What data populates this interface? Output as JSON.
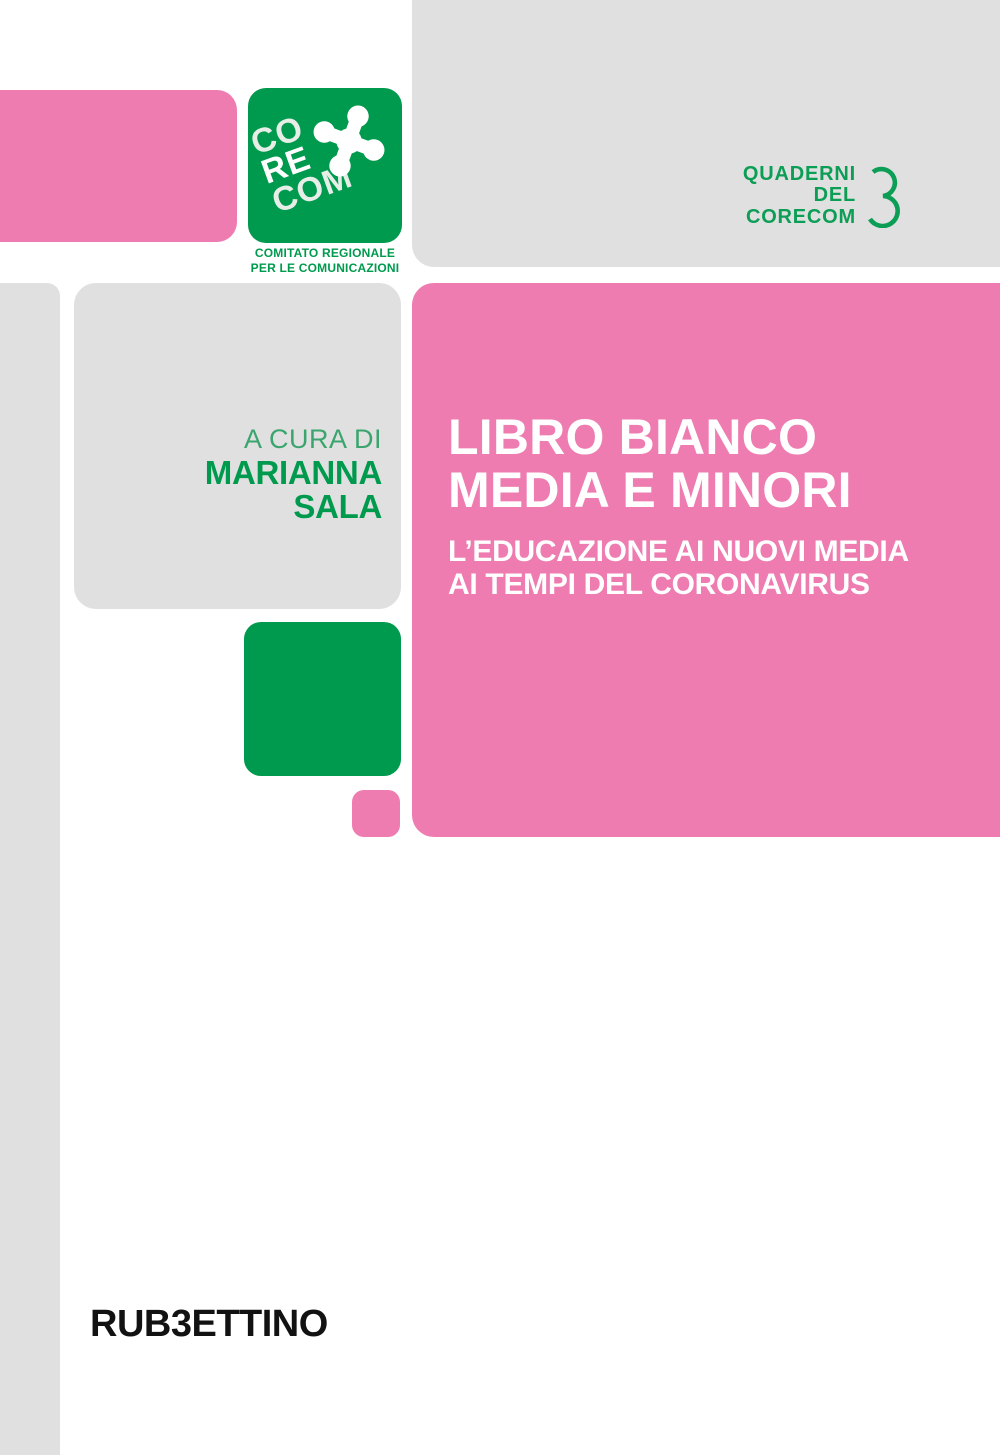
{
  "colors": {
    "pink": "#ee7cb0",
    "green": "#009a4e",
    "light_gray": "#e0e0e1",
    "logo_text_tint": "#e6eee7",
    "author_prefix_green": "#3ba56e",
    "publisher_black": "#121212",
    "white": "#ffffff"
  },
  "corecom_logo": {
    "text_line1": "CO",
    "text_line2": "RE",
    "text_line3": "COM",
    "caption_line1": "COMITATO REGIONALE",
    "caption_line2": "PER LE COMUNICAZIONI"
  },
  "series_badge": {
    "line1": "QUADERNI",
    "line2": "DEL",
    "line3": "CORECOM",
    "number": "3"
  },
  "author": {
    "prefix": "A CURA DI",
    "name_line1": "MARIANNA",
    "name_line2": "SALA"
  },
  "title": {
    "line1": "LIBRO BIANCO",
    "line2": "MEDIA E MINORI"
  },
  "subtitle": {
    "line1": "L’EDUCAZIONE AI NUOVI MEDIA",
    "line2": "AI TEMPI DEL CORONAVIRUS"
  },
  "publisher": {
    "text_before": "RUB",
    "stylized_b": "3",
    "text_after": "ETTINO"
  }
}
